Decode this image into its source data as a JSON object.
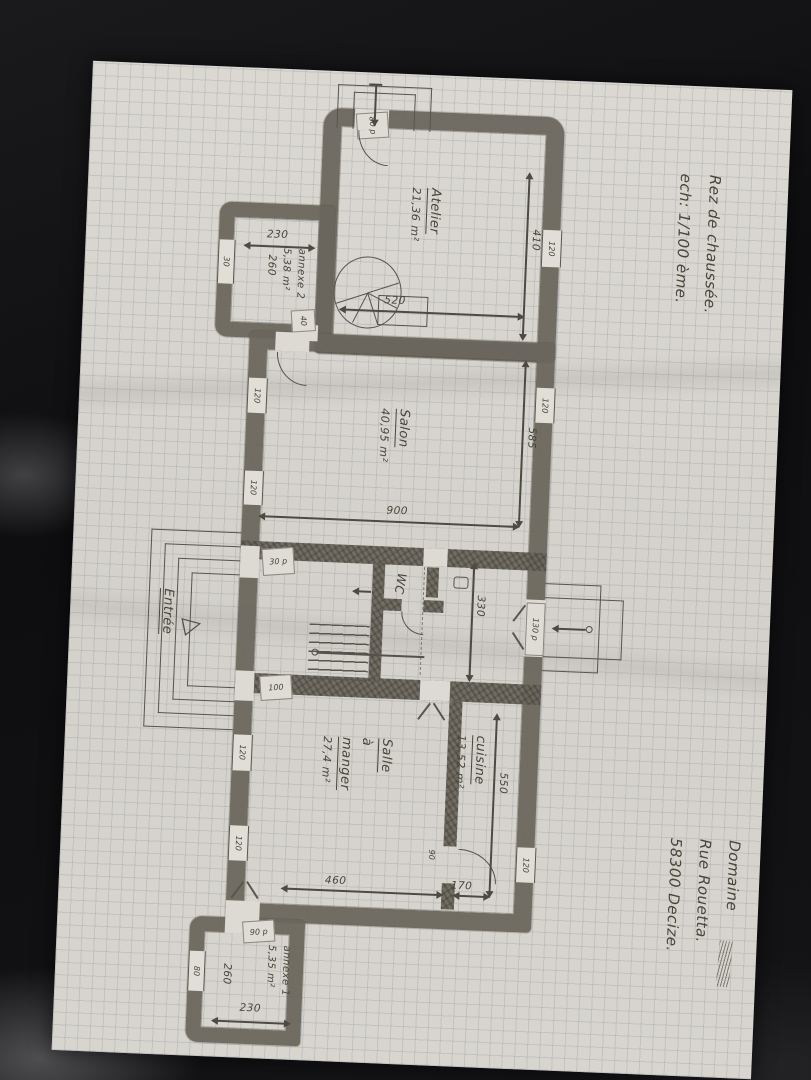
{
  "header": {
    "title": "Rez de chaussée.",
    "scale": "ech: 1/100 ème."
  },
  "address": {
    "line1": "Domaine",
    "line2": "Rue Rouetta.",
    "line3": "58300 Decize."
  },
  "rooms": {
    "atelier": {
      "name": "Atelier",
      "area": "21,36 m²"
    },
    "salon": {
      "name": "Salon",
      "area": "40,95 m²"
    },
    "salle_a_manger": {
      "name_line1": "Salle",
      "name_line2": "à",
      "name_line3": "manger",
      "area": "27,4 m²"
    },
    "cuisine": {
      "name": "cuisine",
      "area": "13,52 m²"
    },
    "wc": {
      "name": "WC"
    },
    "entree": {
      "name": "Entrée"
    },
    "annexe2": {
      "name": "annexe 2",
      "area": "5,38 m²"
    },
    "annexe1": {
      "name": "annexe 1",
      "area": "5,35 m²"
    }
  },
  "dimensions": {
    "atelier_depth": "410",
    "atelier_width": "520",
    "salon_depth": "585",
    "salon_width": "900",
    "hall_depth": "330",
    "dining_depth": "550",
    "dining_width": "460",
    "cuisine_width": "170",
    "annexe2_width": "230",
    "annexe2_depth": "260",
    "annexe1_width": "230",
    "annexe1_depth": "260"
  },
  "openings": {
    "window_large": "120",
    "annexe2_window": "30",
    "annexe1_window": "80",
    "atelier_door": "80 p",
    "annexe2_door": "40",
    "hall_upper_door": "30 p",
    "hall_lower_door": "100",
    "hall_right_door": "130 p",
    "annexe1_door": "90 p",
    "cuisine_door": "90"
  },
  "icons": {
    "entrance_arrow": "▷"
  }
}
